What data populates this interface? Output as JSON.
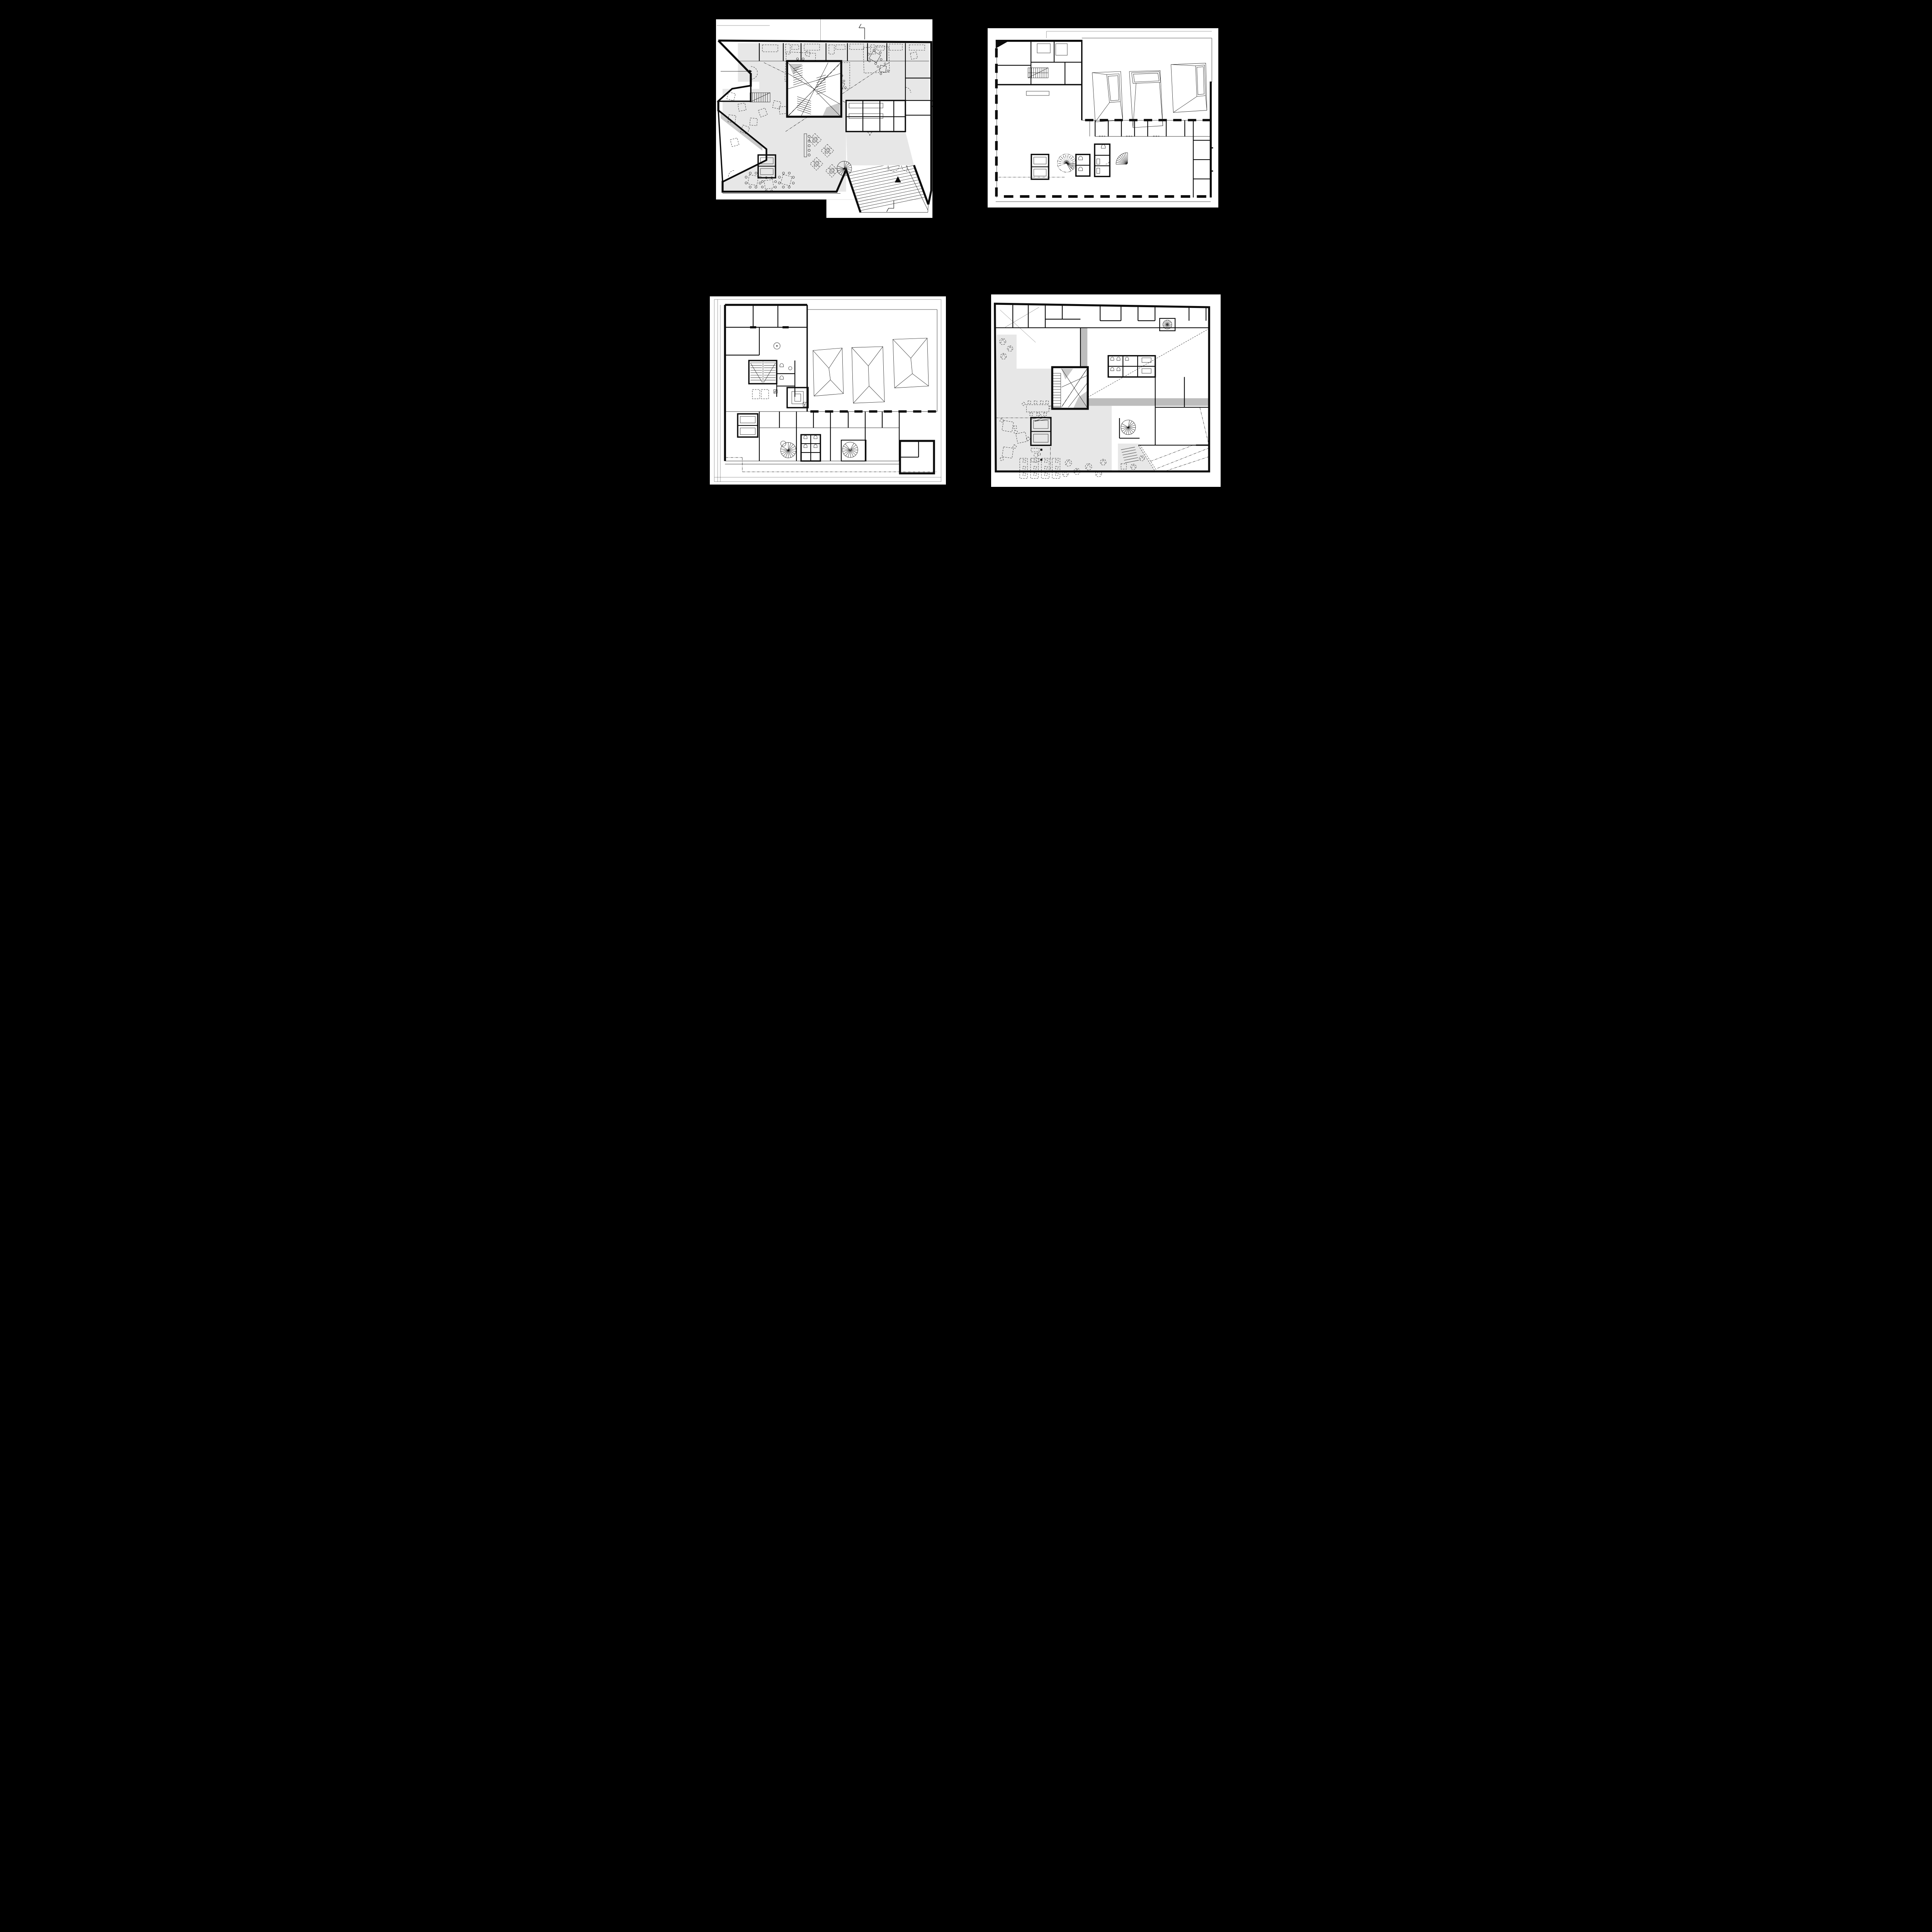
{
  "document": {
    "type": "architectural-floor-plan-sheet",
    "panel_count": 4,
    "background_color": "#000000",
    "sheet_color": "#ffffff"
  },
  "colors": {
    "wall_ink": "#0b0b0b",
    "line_ink": "#161616",
    "public_floor_tint": "#e7e7e7",
    "void_band_gray": "#bdbdbd",
    "stair_shadow_gray": "#c9c9c9"
  },
  "panels": [
    {
      "id": "floor-plan-1",
      "position": "top-left",
      "shaded_public_floor": true,
      "symbols": [
        "section-marker",
        "entrance-arrow",
        "door-swing-arcs",
        "scissor-stair",
        "straight-stair",
        "spiral-stair",
        "elevator-pair",
        "event-carpet-dashed-squares",
        "round-tables-with-chairs",
        "lounge-cushions",
        "seat-clusters",
        "stepped-forecourt-hatching",
        "counter-with-stools"
      ]
    },
    {
      "id": "floor-plan-2",
      "position": "top-right",
      "shaded_public_floor": false,
      "symbols": [
        "pier-facade-dashes",
        "roof-skylight-funnels",
        "straight-stair",
        "elevator-pair",
        "spiral-stair-dashdot",
        "quarter-spiral-stair",
        "wc-fixtures",
        "office-partitions",
        "property-line-dashdot",
        "service-counter"
      ]
    },
    {
      "id": "floor-plan-3",
      "position": "bottom-left",
      "shaded_public_floor": false,
      "symbols": [
        "site-boundary-lines",
        "property-line-dashdot",
        "roof-skylight-funnels",
        "straight-stair",
        "elevator-pair-dashed",
        "spiral-stairs",
        "wc-fixtures",
        "concentric-service-shaft",
        "electrical-riser-bolt",
        "round-column",
        "pier-facade-dashes"
      ]
    },
    {
      "id": "floor-plan-4",
      "position": "bottom-right",
      "shaded_public_floor": true,
      "symbols": [
        "double-height-void",
        "void-edge-gray-band",
        "diagonal-sightline-dashed",
        "scissor-stair",
        "straight-stair",
        "elevator-pair",
        "spiral-stair",
        "small-spiral-stair",
        "wc-fixtures",
        "meeting-table-with-chairs",
        "workstation-desks",
        "cone-lounge-chairs",
        "sofas",
        "terrace-dashdot-hatching"
      ]
    }
  ]
}
